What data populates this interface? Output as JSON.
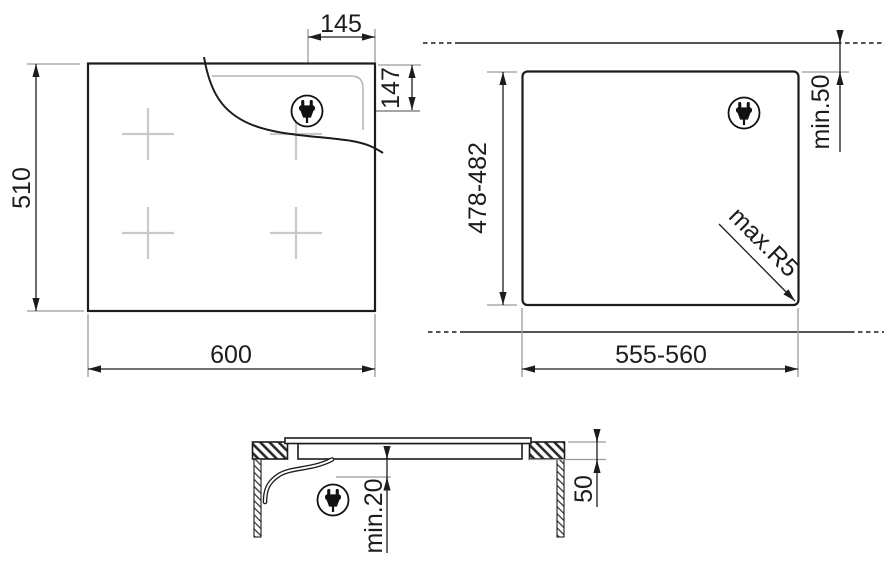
{
  "page": {
    "background": "#ffffff",
    "line_color": "#1c1c1c",
    "extension_line_color": "#9a9a9a",
    "cooking_zone_color": "#c9c9c9"
  },
  "views": {
    "top": {
      "name": "hob-top-view",
      "width_label": "600",
      "depth_label": "510",
      "plug_x_label": "145",
      "plug_y_label": "147",
      "cooking_zone_count": 4,
      "plug_icon": "power-plug-icon"
    },
    "cutout": {
      "name": "worktop-cutout-view",
      "width_label": "555-560",
      "depth_label": "478-482",
      "rear_clearance_label": "min.50",
      "corner_radius_label": "max.R5",
      "plug_icon": "power-plug-icon"
    },
    "section": {
      "name": "side-section-view",
      "worktop_thickness_label": "50",
      "bottom_clearance_label": "min.20",
      "plug_icon": "power-plug-icon"
    }
  }
}
